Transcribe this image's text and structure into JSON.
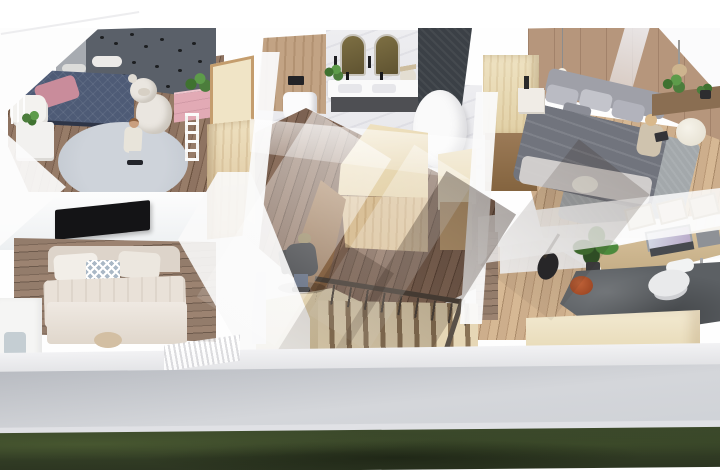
{
  "scene": {
    "kind": "architectural-3d-cutaway-render",
    "rooms": [
      "kids-bedroom",
      "bathroom",
      "master-bedroom",
      "guest-bedroom",
      "hallway",
      "staircase",
      "home-office"
    ],
    "objects": [
      "kids-bed",
      "teddy-bear",
      "pink-dresser",
      "round-rug",
      "wall-tv",
      "guest-bed",
      "toilet",
      "double-vanity",
      "arched-mirrors",
      "bathtub",
      "master-bed",
      "pendant-lights",
      "wardrobe-blocks",
      "stairs-railing",
      "desk",
      "laptop",
      "office-chair",
      "potted-plant",
      "guitar",
      "grass-strip",
      "facade-band",
      "child-figure",
      "walking-person",
      "sitting-person"
    ]
  },
  "palette": {
    "kidsWallDark": "#5a6069",
    "pawBlack": "#1c1e20",
    "kidsBedNavy": "#4e5b76",
    "kidsBedFrame": "#2e3547",
    "pillowPink": "#c98c9b",
    "dresserPink": "#e2aab5",
    "teddyWhite": "#eae6e0",
    "rugGray": "#c7ccd3",
    "marbleWhite": "#ebebed",
    "woodPanelTan": "#c2a384",
    "mirrorOlive": "#6f6239",
    "vanityDark": "#4e4f53",
    "darkTileWall": "#3b4046",
    "tubWhite": "#fafafa",
    "plywoodCream": "#ecdfbe",
    "plywoodTan": "#d9c098",
    "plywoodDark": "#8f6c4e",
    "masterWallTan": "#b6967c",
    "bedGray": "#9fa0a8",
    "duvetGray": "#71747d",
    "bedCream": "#e9e1d8",
    "cushionBlue": "#aab8c6",
    "tvBlack": "#141416",
    "officeRug": "#5c6064",
    "deskWood": "#cbb491",
    "plantGreen": "#4c7d3c",
    "terracotta": "#b05330",
    "guitarBlack": "#26262a",
    "stairWood": "#e6d7b6",
    "stairGap": "#8a7356",
    "railDark": "#4a423a",
    "facadeMid": "#cbced4",
    "grassDark": "#2c3521",
    "grassMid": "#3c4a2b",
    "skinTan": "#c99f7f",
    "jacketDark": "#26282c",
    "jeans": "#46536b",
    "capOlive": "#8b7b52"
  }
}
